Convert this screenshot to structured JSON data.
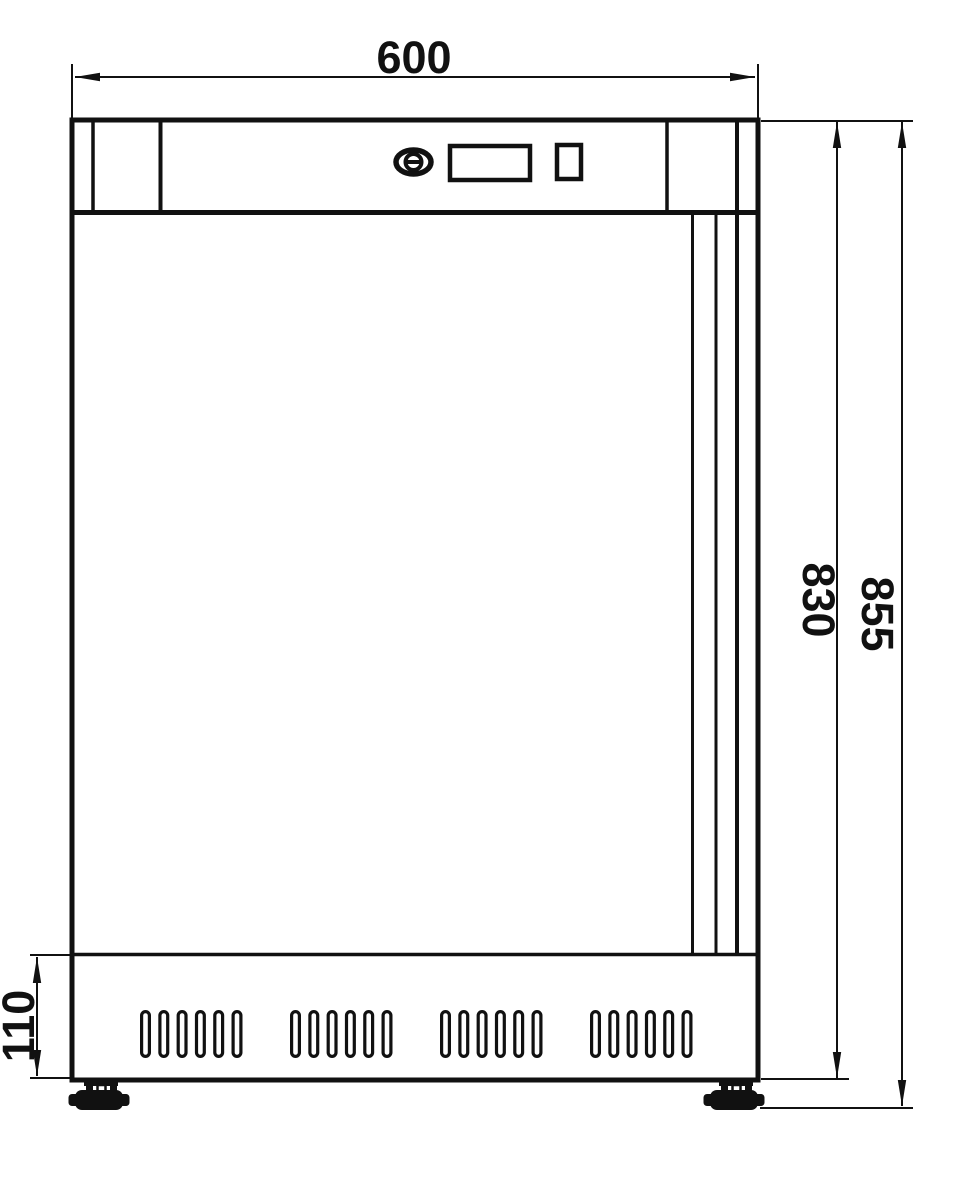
{
  "drawing": {
    "type": "technical-front-view",
    "colors": {
      "line": "#111111",
      "background": "#ffffff"
    },
    "dimensions": {
      "overall_width": "600",
      "body_height": "830",
      "total_height": "855",
      "plinth_height": "110"
    },
    "vents": {
      "group_start_x": [
        140,
        290,
        440,
        590
      ],
      "slots_per_group": 6,
      "slot_pitch": 18.3,
      "slot_outer_width": 11,
      "slot_outer_height": 48,
      "slot_top_y": 1010,
      "stroke_width": 3.2
    }
  }
}
